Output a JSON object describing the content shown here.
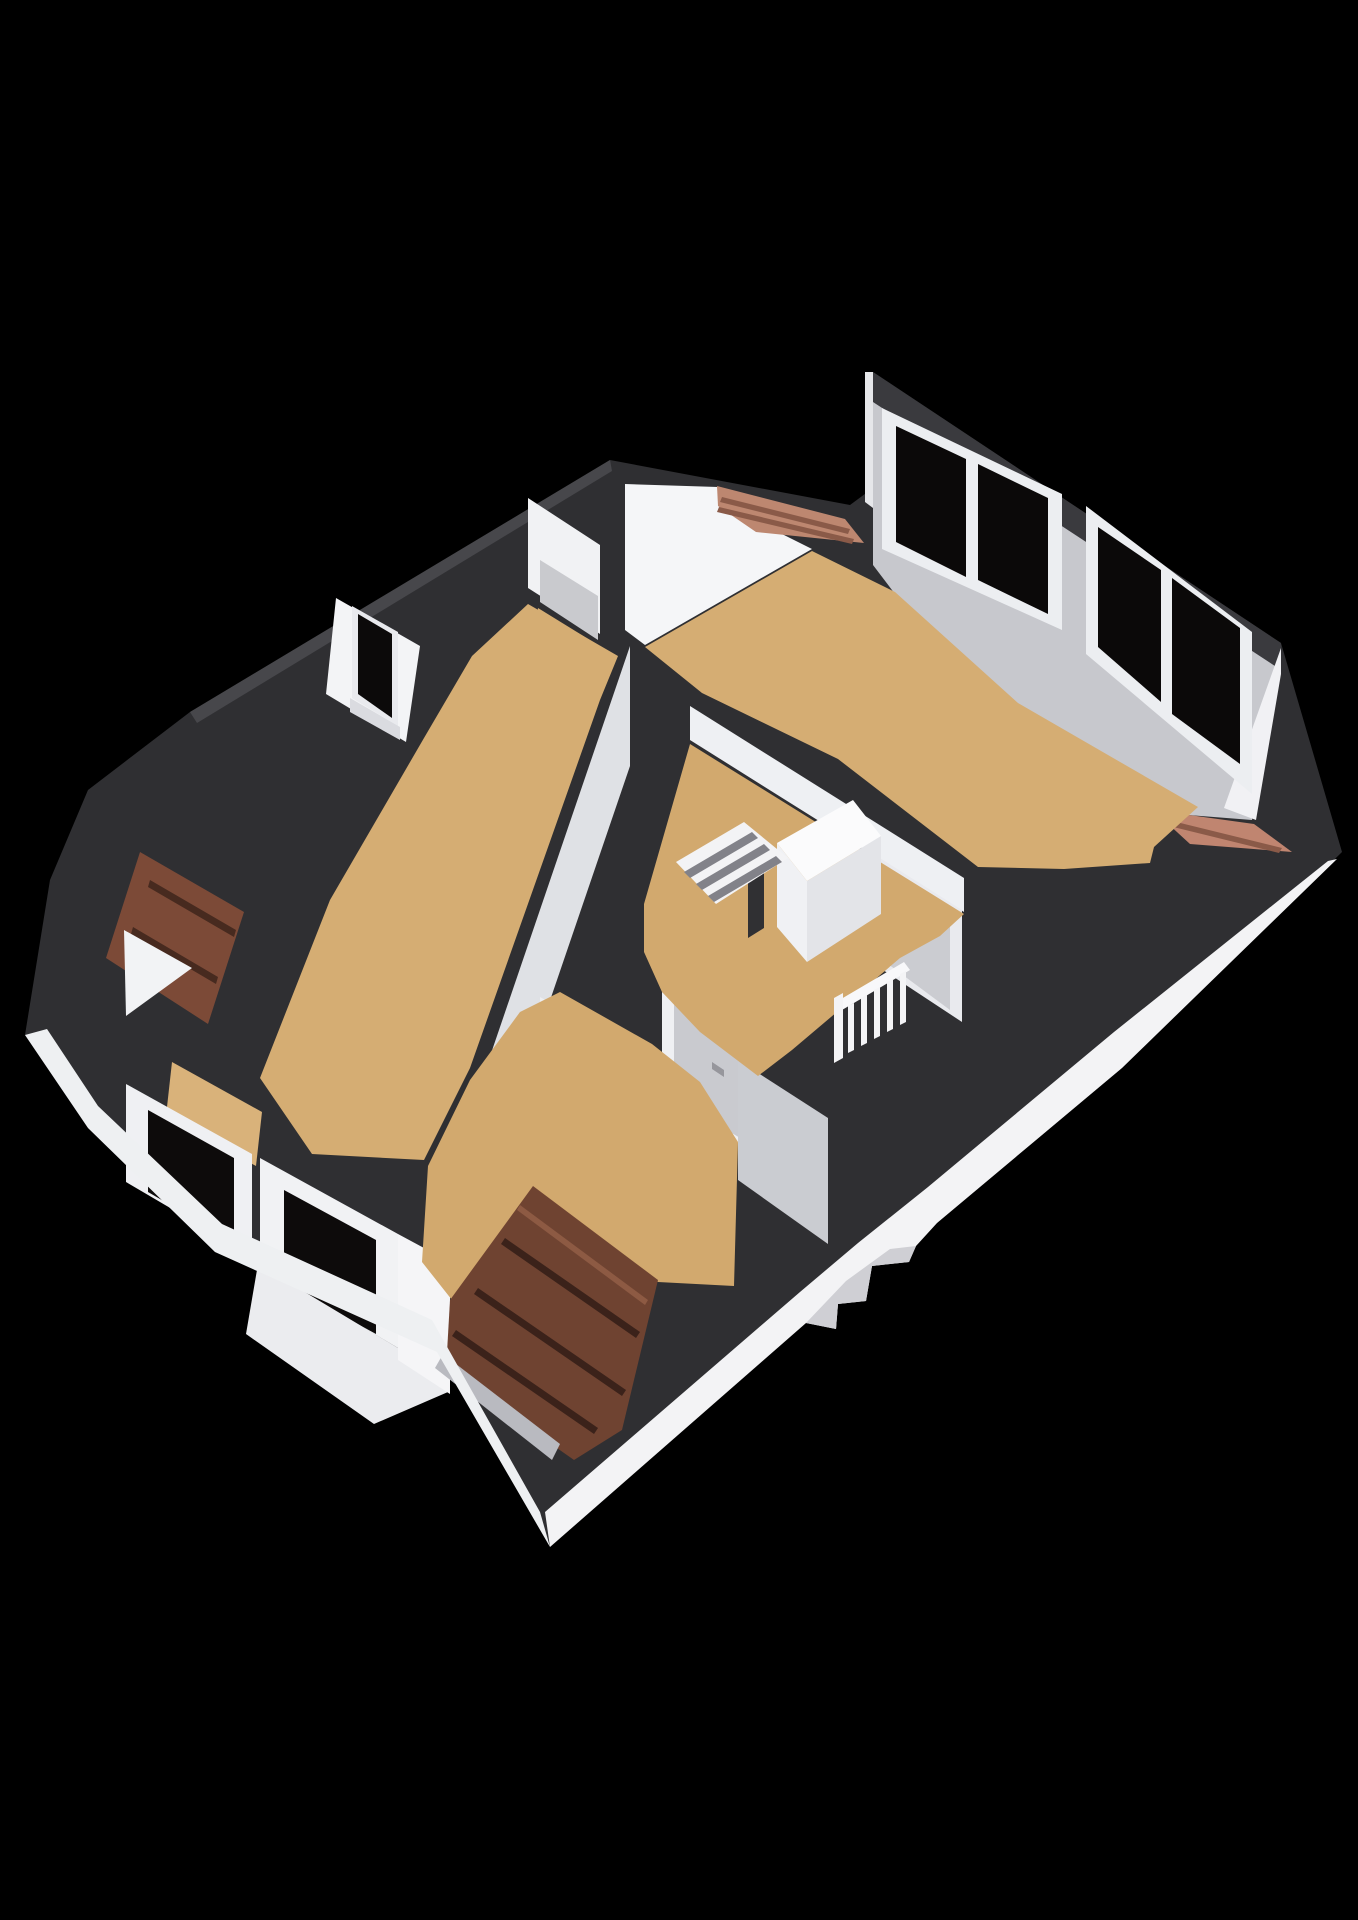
{
  "canvas": {
    "width": 1358,
    "height": 1920,
    "background": "#000000"
  },
  "palette": {
    "background": "#000000",
    "wall_cut_band": "#2f2f32",
    "dormer_band": "#3a3a3e",
    "exterior_wall_white": "#f3f3f5",
    "interior_wall_gray": "#c7c8cd",
    "interior_wall_light": "#eef0f3",
    "floor_wood": "#d5ad73",
    "roof_tiles_dark": "#6f4331",
    "roof_tiles_light": "#bd8770",
    "window_glass": "#0b0909",
    "window_frame": "#eceef1",
    "door_gray": "#c9cacf",
    "railing_white": "#f4f4f6"
  },
  "scene": {
    "polygons": [
      {
        "name": "silhouette-cut-band",
        "fill": "#2f2f32",
        "points": "610,460 850,505 873,488 873,372 1281,643 1342,852 1122,1068 937,1223 916,1246 909,1262 872,1266 866,1301 838,1304 836,1329 806,1323 550,1547 437,1352 215,1252 88,1128 25,1035 50,880 88,790 190,712"
      },
      {
        "name": "silhouette-edge-highlight",
        "fill": "#47474b",
        "points": "610,460 190,712 197,723 612,471"
      },
      {
        "name": "closet-west-wall-face",
        "fill": "#f1f2f4",
        "points": "528,498 528,588 600,634 600,545"
      },
      {
        "name": "closet-inner-wall-face",
        "fill": "#c9cace",
        "points": "540,560 598,596 598,640 540,602"
      },
      {
        "name": "closet-floor",
        "fill": "#d5ae74",
        "points": "538,608 598,645 592,692 532,652"
      },
      {
        "name": "bedroom-ne-gable-wall-face",
        "fill": "#f5f6f8",
        "points": "625,484 718,487 748,517 812,549 645,645 625,630"
      },
      {
        "name": "dormer-roof-band",
        "fill": "#3a3a3e",
        "points": "873,372 1281,643 1281,670 873,402"
      },
      {
        "name": "dormer-left-trim",
        "fill": "#e6e7ea",
        "points": "865,372 873,372 873,508 865,502"
      },
      {
        "name": "dormer-wall-face",
        "fill": "#c7c8cd",
        "points": "873,402 1281,670 1252,820 1150,812 1014,704 895,594 873,565"
      },
      {
        "name": "dormer-end-cap",
        "fill": "#f1f1f4",
        "points": "1281,648 1281,674 1256,820 1224,808"
      },
      {
        "name": "dormer-window-1-frame",
        "fill": "#eceef1",
        "points": "882,408 1062,494 1062,630 882,549"
      },
      {
        "name": "dormer-window-1-glass-left",
        "fill": "#0b0909",
        "points": "896,426 966,459 966,577 896,542"
      },
      {
        "name": "dormer-window-1-glass-right",
        "fill": "#0b0909",
        "points": "978,464 1048,498 1048,614 978,580"
      },
      {
        "name": "dormer-window-2-frame",
        "fill": "#eceef1",
        "points": "1086,506 1252,632 1252,794 1086,654"
      },
      {
        "name": "dormer-window-2-glass-left",
        "fill": "#0b0909",
        "points": "1098,527 1161,570 1161,702 1098,647"
      },
      {
        "name": "dormer-window-2-glass-right",
        "fill": "#0b0909",
        "points": "1172,578 1240,628 1240,764 1172,714"
      },
      {
        "name": "roof-tiles-right-strip",
        "fill": "#c08570",
        "points": "1153,810 1254,824 1292,852 1190,844"
      },
      {
        "name": "roof-tiles-right-strip-line",
        "fill": "#8a5a48",
        "points": "1160,818 1282,848 1279,853 1157,823"
      },
      {
        "name": "bedroom-ne-floor",
        "fill": "#d5ad73",
        "points": "645,647 812,551 895,592 1018,703 1198,807 1154,847 1150,863 1064,869 978,867 838,759 702,693"
      },
      {
        "name": "roof-tiles-top-center",
        "fill": "#bd8770",
        "points": "717,486 845,519 864,543 756,532 718,506"
      },
      {
        "name": "roof-tiles-top-center-line-1",
        "fill": "#8a5a48",
        "points": "722,497 850,529 848,534 720,502"
      },
      {
        "name": "roof-tiles-top-center-line-2",
        "fill": "#8a5a48",
        "points": "719,507 854,539 852,544 717,512"
      },
      {
        "name": "bedroom-south-wall-face",
        "fill": "#eef0f3",
        "points": "690,706 964,878 964,912 690,740"
      },
      {
        "name": "landing-east-wall-face",
        "fill": "#e9eaee",
        "points": "880,858 962,910 962,1022 880,968"
      },
      {
        "name": "door-east",
        "fill": "#cbccd1",
        "points": "888,868 950,906 950,1010 888,964"
      },
      {
        "name": "door-east-handle",
        "fill": "#96969c",
        "points": "897,888 909,896 909,903 897,895"
      },
      {
        "name": "left-room-east-wall-face",
        "fill": "#dfe1e5",
        "points": "630,646 456,1156 456,1276 630,766"
      },
      {
        "name": "landing-west-wall-face",
        "fill": "#eff0f3",
        "points": "662,992 758,1048 758,1155 662,1098"
      },
      {
        "name": "door-landing-west",
        "fill": "#c9cacf",
        "points": "674,1002 750,1046 750,1144 674,1098"
      },
      {
        "name": "door-landing-west-handle",
        "fill": "#96969c",
        "points": "712,1062 724,1070 724,1077 712,1069"
      },
      {
        "name": "south-room-north-wall-face",
        "fill": "#edeef1",
        "points": "540,997 660,1064 660,1162 540,1092"
      },
      {
        "name": "door-south-room",
        "fill": "#c9cacf",
        "points": "600,1032 650,1060 650,1154 600,1124"
      },
      {
        "name": "door-south-room-handle",
        "fill": "#96969c",
        "points": "607,1064 619,1071 619,1078 607,1071"
      },
      {
        "name": "south-room-se-wall-face",
        "fill": "#caccd1",
        "points": "738,1060 828,1118 828,1244 738,1180"
      },
      {
        "name": "landing-floor",
        "fill": "#d2a96e",
        "points": "690,744 964,914 940,936 900,958 844,1006 792,1050 758,1076 700,1032 662,992 644,952 644,904"
      },
      {
        "name": "stairwell-box-face-sw",
        "fill": "#f0f1f4",
        "points": "777,843 807,881 807,962 777,927"
      },
      {
        "name": "stairwell-box-face-se",
        "fill": "#e3e4e8",
        "points": "807,881 881,836 881,914 807,962"
      },
      {
        "name": "stairwell-box-top",
        "fill": "#fbfbfc",
        "points": "777,843 853,800 881,836 807,881"
      },
      {
        "name": "stair-void",
        "fill": "#303033",
        "points": "748,856 764,846 764,928 748,938"
      },
      {
        "name": "stair-treads",
        "fill": "#f3f3f5",
        "points": "676,862 744,822 788,858 716,904"
      },
      {
        "name": "stair-tread-shadow-1",
        "fill": "#828289",
        "points": "684,872 752,832 758,838 690,878"
      },
      {
        "name": "stair-tread-shadow-2",
        "fill": "#828289",
        "points": "696,884 764,844 770,850 702,890"
      },
      {
        "name": "stair-tread-shadow-3",
        "fill": "#828289",
        "points": "708,896 776,856 782,862 714,902"
      },
      {
        "name": "stair-railing-top-rail",
        "fill": "#f8f8fa",
        "points": "836,1002 904,962 910,970 842,1010"
      },
      {
        "name": "stair-railing-newel",
        "fill": "#f4f4f6",
        "points": "834,998 843,993 843,1058 834,1063"
      },
      {
        "name": "stair-railing-baluster-1",
        "fill": "#f4f4f6",
        "points": "848,1006 854,1003 854,1050 848,1053"
      },
      {
        "name": "stair-railing-baluster-2",
        "fill": "#f4f4f6",
        "points": "861,998 867,995 867,1043 861,1046"
      },
      {
        "name": "stair-railing-baluster-3",
        "fill": "#f4f4f6",
        "points": "874,990 880,987 880,1036 874,1039"
      },
      {
        "name": "stair-railing-baluster-4",
        "fill": "#f4f4f6",
        "points": "887,982 893,979 893,1029 887,1032"
      },
      {
        "name": "stair-railing-baluster-5",
        "fill": "#f4f4f6",
        "points": "900,974 906,971 906,1022 900,1025"
      },
      {
        "name": "left-room-nw-wall-face",
        "fill": "#f3f4f6",
        "points": "336,598 420,646 406,742 326,694"
      },
      {
        "name": "left-window-frame",
        "fill": "#e9eaee",
        "points": "352,606 398,632 398,726 352,698"
      },
      {
        "name": "left-window-glass",
        "fill": "#0c0a0a",
        "points": "358,614 392,634 392,718 358,694"
      },
      {
        "name": "left-window-sill",
        "fill": "#dadbe0",
        "points": "350,698 400,727 400,740 350,712"
      },
      {
        "name": "left-room-floor",
        "fill": "#d5ad73",
        "points": "528,604 618,656 600,700 470,1068 424,1160 312,1154 260,1078 330,900 424,738 472,656"
      },
      {
        "name": "left-dormer-roof-tiles",
        "fill": "#7c4a37",
        "points": "140,852 244,912 208,1024 106,958"
      },
      {
        "name": "left-dormer-tiles-line-1",
        "fill": "#472a1f",
        "points": "150,880 236,930 234,937 148,887"
      },
      {
        "name": "left-dormer-tiles-line-2",
        "fill": "#472a1f",
        "points": "133,927 218,977 216,984 131,934"
      },
      {
        "name": "left-dormer-gable",
        "fill": "#f2f3f5",
        "points": "124,930 192,968 126,1016"
      },
      {
        "name": "bay-floor-sliver",
        "fill": "#d9b27a",
        "points": "172,1062 262,1112 256,1166 166,1116"
      },
      {
        "name": "bay-window-1-frame",
        "fill": "#eff0f3",
        "points": "126,1084 252,1154 252,1256 126,1182"
      },
      {
        "name": "bay-window-1-glass",
        "fill": "#0d0b0b",
        "points": "148,1110 234,1158 234,1242 148,1192"
      },
      {
        "name": "bay-window-2-frame",
        "fill": "#f1f2f4",
        "points": "260,1158 398,1234 398,1348 260,1266"
      },
      {
        "name": "bay-window-2-glass",
        "fill": "#0d0b0b",
        "points": "284,1190 376,1240 376,1334 284,1284"
      },
      {
        "name": "bay-window-base",
        "fill": "#ebecef",
        "points": "258,1264 398,1348 448,1392 374,1424 246,1334"
      },
      {
        "name": "bay-pillar",
        "fill": "#f5f5f7",
        "points": "398,1234 450,1262 450,1394 398,1360"
      },
      {
        "name": "south-room-floor",
        "fill": "#d2a96e",
        "points": "560,992 652,1044 700,1082 738,1142 734,1286 658,1282 533,1188 452,1300 422,1262 428,1166 470,1080 520,1012"
      },
      {
        "name": "south-dormer-roof-tiles",
        "fill": "#6f4331",
        "points": "533,1186 658,1280 622,1430 574,1460 446,1370 450,1300"
      },
      {
        "name": "south-dormer-tiles-highlight",
        "fill": "#8d5a43",
        "points": "520,1205 648,1300 645,1305 517,1210"
      },
      {
        "name": "south-dormer-tiles-line-1",
        "fill": "#3b221a",
        "points": "505,1238 640,1332 636,1338 501,1244"
      },
      {
        "name": "south-dormer-tiles-line-2",
        "fill": "#3b221a",
        "points": "478,1288 626,1390 622,1396 474,1294"
      },
      {
        "name": "south-dormer-tiles-line-3",
        "fill": "#3b221a",
        "points": "456,1330 598,1428 594,1434 452,1336"
      },
      {
        "name": "south-dormer-gutter",
        "fill": "#b9bac0",
        "points": "443,1354 560,1444 552,1460 435,1368"
      },
      {
        "name": "exterior-roof-wedge",
        "fill": "#f3f3f5",
        "points": "1337,859 1122,1068 937,1223 916,1246 909,1262 872,1266 866,1301 838,1304 836,1329 806,1323 550,1547 545,1512 800,1292 858,1243 928,1187 1114,1032 1328,861"
      },
      {
        "name": "exterior-step-bulkhead-shading",
        "fill": "#cfcfd4",
        "points": "916,1246 909,1262 872,1266 866,1301 838,1304 836,1329 806,1323 846,1281 890,1249"
      },
      {
        "name": "exterior-wall-strip-left",
        "fill": "#eef0f2",
        "points": "25,1035 88,1128 215,1252 437,1352 550,1547 540,1512 432,1320 222,1224 98,1106 47,1029"
      }
    ]
  }
}
